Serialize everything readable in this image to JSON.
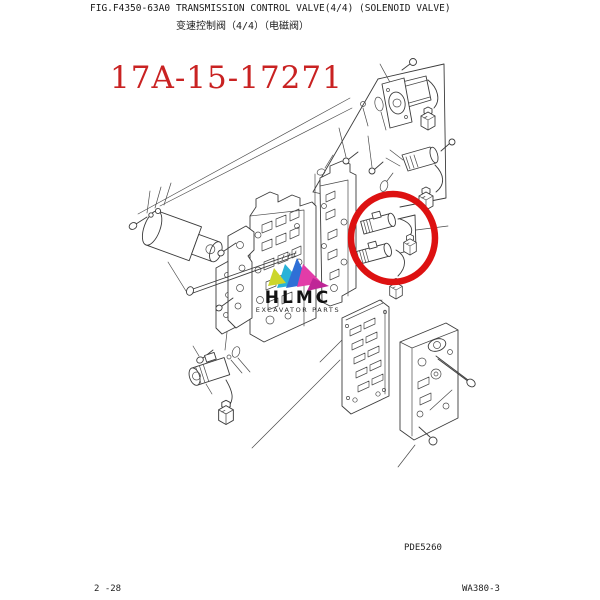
{
  "header": {
    "fig_code": "FIG.F4350-63A0",
    "title_en": "TRANSMISSION CONTROL VALVE(4/4) (SOLENOID VALVE)",
    "title_zh": "变速控制阀（4/4）（电磁阀）"
  },
  "part_number": "17A-15-17271",
  "logo": {
    "name": "HLMC",
    "tagline": "EXCAVATOR PARTS"
  },
  "diagram": {
    "plate_code": "PDE5260",
    "highlight_note": "red circle marking solenoid valve assembly"
  },
  "footer": {
    "page_code": "2 -28",
    "model_code": "WA380-3"
  },
  "colors": {
    "part_number_red": "#c92222",
    "highlight_red": "#dd1111",
    "line": "#3c3c3c",
    "logo_yellow": "#ccd62b",
    "logo_cyan": "#2ab2d8",
    "logo_blue": "#2f6fd6",
    "logo_magenta": "#e23ca8",
    "logo_magenta_dark": "#bf2697"
  }
}
